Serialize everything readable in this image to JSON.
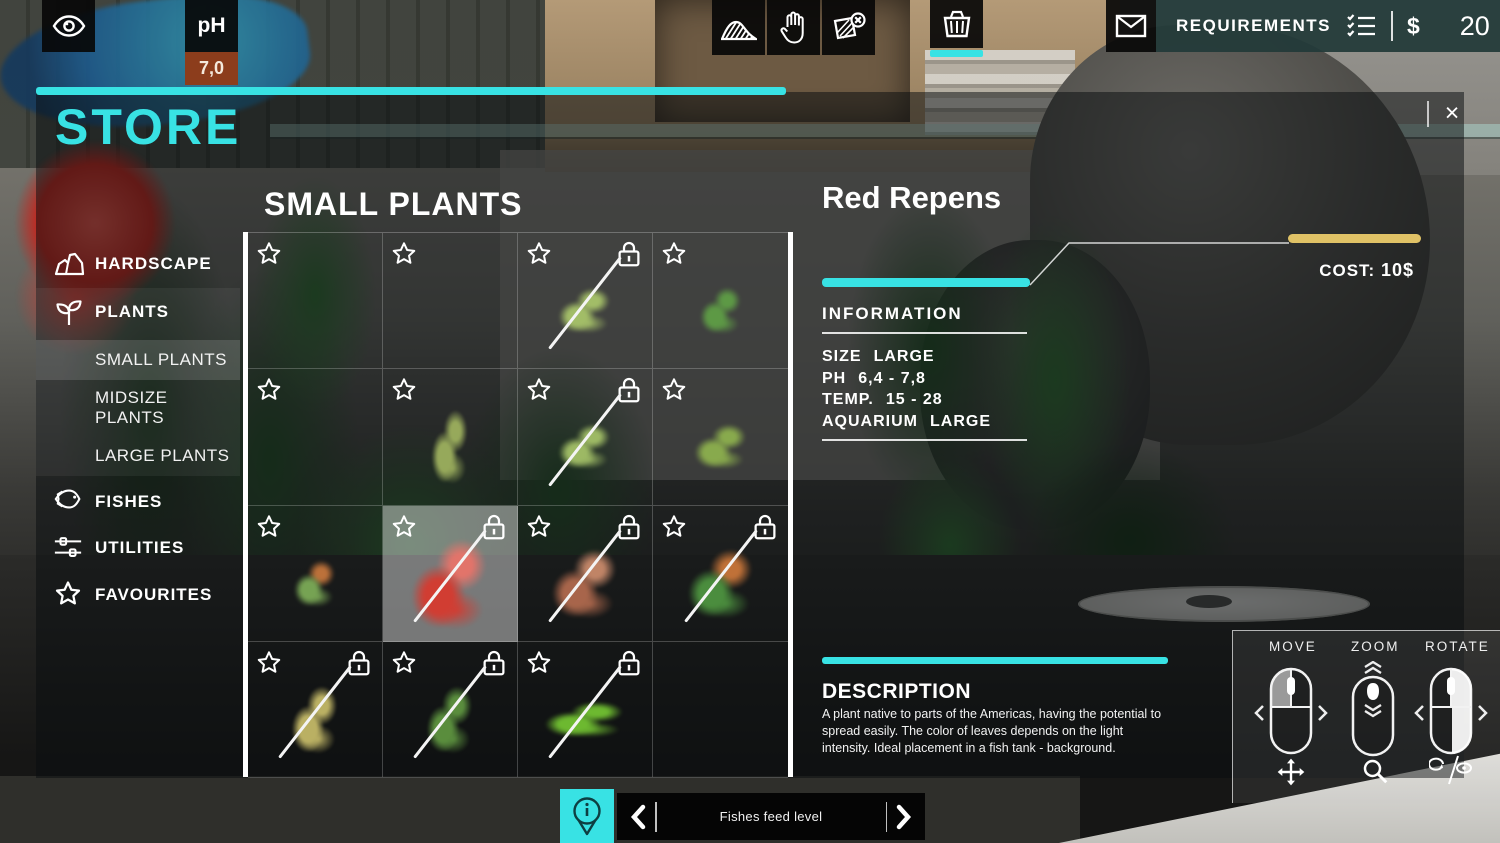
{
  "colors": {
    "accent_cyan": "#38e2e4",
    "cost_gold": "#e0c266",
    "ph_orange": "#8c3d1c",
    "requirements_teal": "#223a39"
  },
  "hud": {
    "eye_button": {
      "icon": "eye-icon"
    },
    "ph": {
      "label": "pH",
      "value": "7,0"
    },
    "tools": [
      {
        "icon": "terrain-sand-icon"
      },
      {
        "icon": "hand-icon"
      },
      {
        "icon": "terrain-erase-icon"
      }
    ],
    "basket": {
      "icon": "basket-icon",
      "selected": true
    },
    "mail": {
      "icon": "envelope-icon"
    },
    "requirements": {
      "label": "REQUIREMENTS",
      "icon": "checklist-icon"
    },
    "currency": {
      "symbol": "$",
      "amount": "20"
    }
  },
  "store": {
    "title": "STORE",
    "close_label": "×",
    "sidebar": {
      "items": [
        {
          "label": "HARDSCAPE",
          "icon": "rock-icon"
        },
        {
          "label": "PLANTS",
          "icon": "plant-icon"
        },
        {
          "label": "SMALL PLANTS",
          "selected": true
        },
        {
          "label": "MIDSIZE PLANTS"
        },
        {
          "label": "LARGE PLANTS"
        },
        {
          "label": "FISHES",
          "icon": "fish-icon"
        },
        {
          "label": "UTILITIES",
          "icon": "sliders-icon"
        },
        {
          "label": "FAVOURITES",
          "icon": "star-icon"
        }
      ]
    },
    "grid": {
      "heading": "SMALL PLANTS",
      "cells": [
        {
          "star": true
        },
        {
          "star": true
        },
        {
          "star": true,
          "lock": true,
          "slash": true,
          "plant": {
            "kind": "sprig",
            "color": "#a8c46a"
          }
        },
        {
          "star": true,
          "plant": {
            "kind": "small-plant",
            "color": "#5f9e46"
          }
        },
        {
          "star": true
        },
        {
          "star": true,
          "plant": {
            "kind": "tall-grass",
            "color": "#9db05e"
          }
        },
        {
          "star": true,
          "lock": true,
          "slash": true,
          "plant": {
            "kind": "sprig",
            "color": "#a4c168"
          }
        },
        {
          "star": true,
          "plant": {
            "kind": "sprig",
            "color": "#8db04e"
          }
        },
        {
          "star": true,
          "plant": {
            "kind": "small-plant",
            "color": "#7cab57",
            "accent": "#c5763c"
          }
        },
        {
          "star": true,
          "lock": true,
          "slash": true,
          "selected": true,
          "plant": {
            "kind": "bush",
            "color": "#d63a2f",
            "accent": "#e8746a"
          }
        },
        {
          "star": true,
          "lock": true,
          "slash": true,
          "plant": {
            "kind": "bush",
            "color": "#b06a4e",
            "accent": "#c98a6b"
          }
        },
        {
          "star": true,
          "lock": true,
          "slash": true,
          "plant": {
            "kind": "bush",
            "color": "#4e9440",
            "accent": "#c9763a"
          }
        },
        {
          "star": true,
          "lock": true,
          "slash": true,
          "plant": {
            "kind": "grass",
            "color": "#c4b968"
          }
        },
        {
          "star": true,
          "lock": true,
          "slash": true,
          "plant": {
            "kind": "grass",
            "color": "#5e9440"
          }
        },
        {
          "star": true,
          "lock": true,
          "slash": true,
          "plant": {
            "kind": "carpet",
            "color": "#72c232"
          }
        },
        {}
      ]
    },
    "detail": {
      "name": "Red Repens",
      "cost_label": "COST:",
      "cost_value": "10$",
      "info_heading": "INFORMATION",
      "info_rows": [
        {
          "label": "SIZE",
          "value": "LARGE"
        },
        {
          "label": "PH",
          "value": "6,4 - 7,8"
        },
        {
          "label": "TEMP.",
          "value": "15 - 28"
        },
        {
          "label": "AQUARIUM",
          "value": "LARGE"
        }
      ],
      "description_heading": "DESCRIPTION",
      "description": "A plant native to parts of the Americas, having the potential to spread easily. The color of leaves depends on the light intensity. Ideal placement in a fish tank - background."
    }
  },
  "controls_help": {
    "items": [
      {
        "label": "MOVE",
        "mouse": "left-button-drag",
        "icon": "move-arrows-icon"
      },
      {
        "label": "ZOOM",
        "mouse": "scroll-wheel",
        "icon": "magnifier-icon"
      },
      {
        "label": "ROTATE",
        "mouse": "right-button-drag",
        "icon": "rotate-view-icon"
      }
    ]
  },
  "bottom_bar": {
    "info_icon": "info-pin-icon",
    "label": "Fishes feed level"
  }
}
